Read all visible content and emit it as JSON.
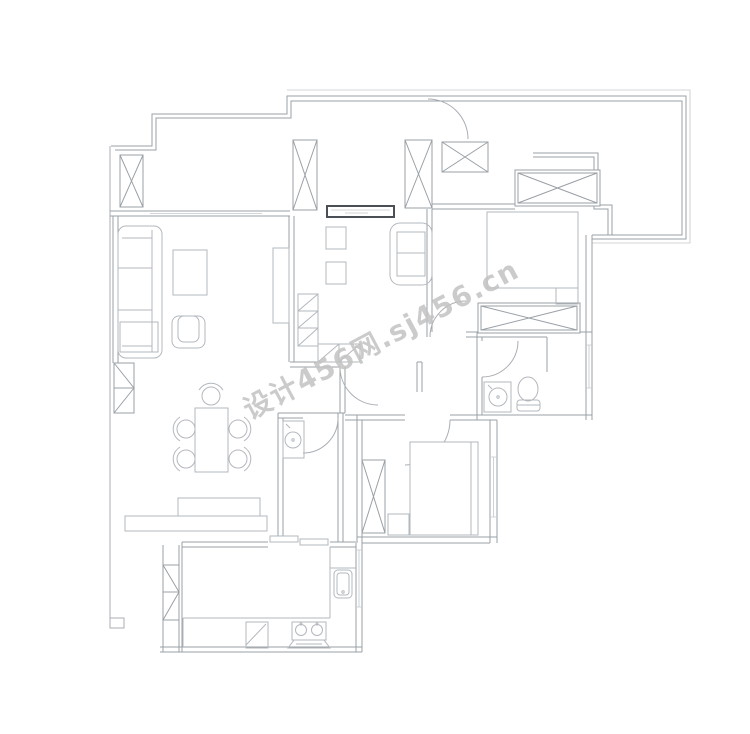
{
  "page": {
    "width": 750,
    "height": 734,
    "background": "#ffffff",
    "type": "apartment-floor-plan-CAD-drawing"
  },
  "watermark": {
    "text": "设计456网.sj456.cn",
    "color": "#c2c2c2",
    "rotation_deg": -28,
    "font_size_px": 28,
    "opacity": 0.85
  },
  "colors": {
    "wall_line": "#9aa0a6",
    "furniture_line": "#b3b8be",
    "accent_window": "#4b5056",
    "thin_line": "#c3c7cc",
    "background": "#ffffff"
  },
  "rooms": {
    "list": [
      "top-left-balcony",
      "living-room",
      "tea-room",
      "entry-hall",
      "master-bedroom",
      "master-balcony",
      "master-bathroom",
      "hallway",
      "laundry-room",
      "second-bedroom",
      "dining-area",
      "kitchen"
    ]
  },
  "symbols": {
    "columns": "crossed-box-structural-columns",
    "doors": "quarter-circle-door-swings",
    "windows": "triple-parallel-line-windows",
    "furniture": [
      "sofa",
      "side-table",
      "coffee-table",
      "armchair",
      "tv-cabinet",
      "tea-table-chairs",
      "loveseat",
      "corner-display-cabinet",
      "entry-wardrobe",
      "bedroom-closet",
      "double-bed",
      "nightstand",
      "bed-wardrobe",
      "toilet",
      "round-wash-basin",
      "washing-machine",
      "single-bed",
      "bedside-cabinet",
      "dining-table",
      "dining-chairs",
      "sideboard",
      "kitchen-counter",
      "kitchen-sink",
      "cooktop-two-burners"
    ]
  }
}
